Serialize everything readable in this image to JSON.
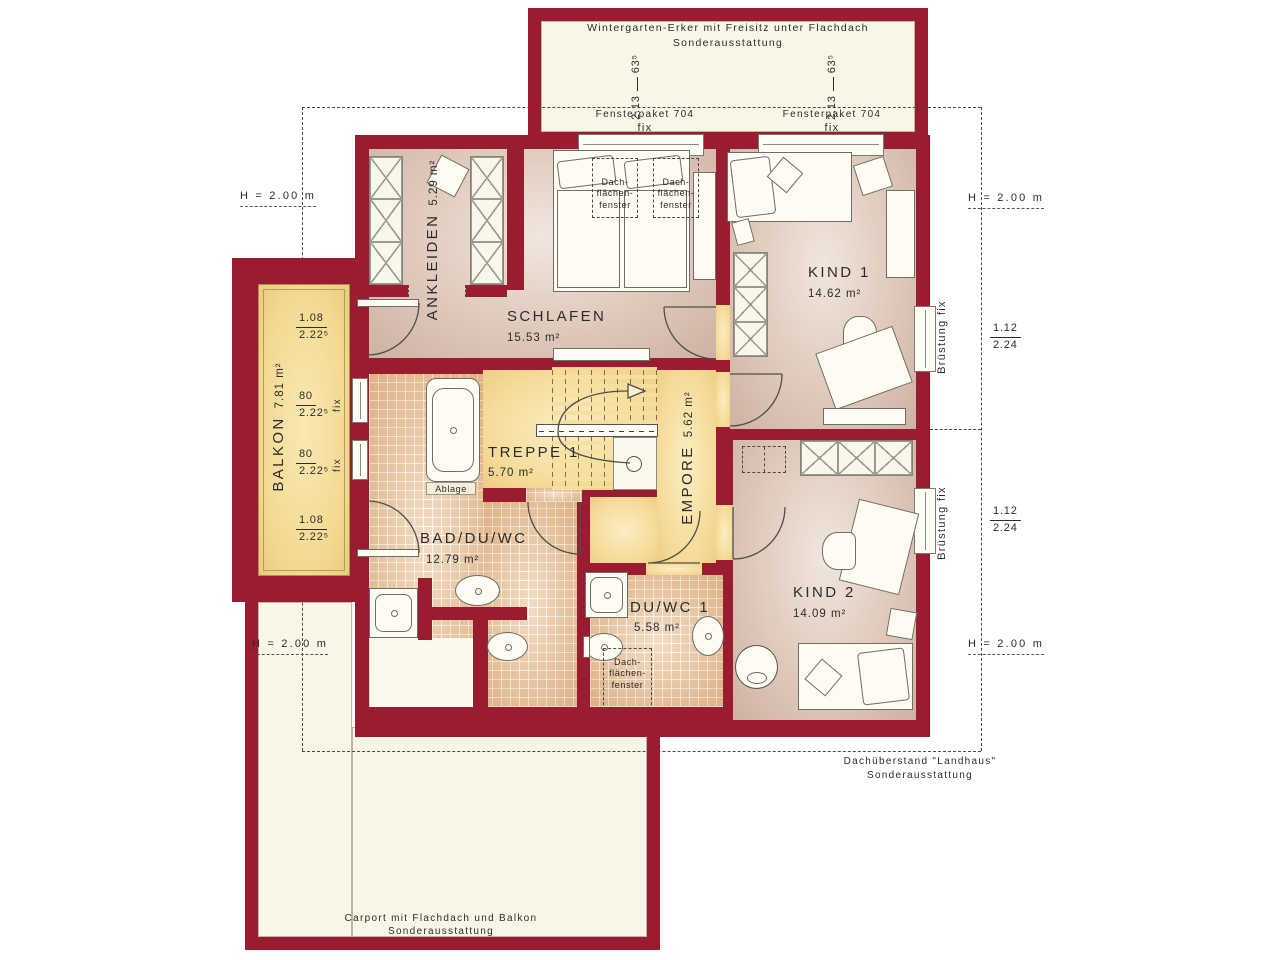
{
  "plan": {
    "title": {
      "line1": "Wintergarten-Erker mit Freisitz unter Flachdach",
      "line2": "Sonderausstattung"
    },
    "rooms": {
      "ankleiden": {
        "name": "ANKLEIDEN",
        "area": "5.29 m²"
      },
      "schlafen": {
        "name": "SCHLAFEN",
        "area": "15.53 m²"
      },
      "kind1": {
        "name": "KIND 1",
        "area": "14.62 m²"
      },
      "kind2": {
        "name": "KIND 2",
        "area": "14.09 m²"
      },
      "balkon": {
        "name": "BALKON",
        "area": "7.81 m²"
      },
      "treppe": {
        "name": "TREPPE 1",
        "area": "5.70 m²"
      },
      "empore": {
        "name": "EMPORE",
        "area": "5.62 m²"
      },
      "bad": {
        "name": "BAD/DU/WC",
        "area": "12.79 m²"
      },
      "duwc": {
        "name": "DU/WC 1",
        "area": "5.58 m²"
      }
    },
    "labels": {
      "height_clearance": "H = 2.00 m",
      "bruestung_fix": "Brüstung fix",
      "fix": "fix",
      "fensterpaket": "Fensterpaket 704",
      "ablage": "Ablage",
      "roof_window": {
        "l1": "Dach-",
        "l2": "flächen-",
        "l3": "fenster"
      },
      "carport": {
        "line1": "Carport mit Flachdach und Balkon",
        "line2": "Sonderausstattung"
      },
      "dachueberstand": {
        "line1": "Dachüberstand \"Landhaus\"",
        "line2": "Sonderausstattung"
      }
    },
    "dims": {
      "bay_window": {
        "num": "2.13",
        "den": "63⁵"
      },
      "balkon_door": {
        "num": "1.08",
        "den": "2.22⁵"
      },
      "balkon_fix": {
        "num": "80",
        "den": "2.22⁵"
      },
      "side_window": {
        "num": "1.12",
        "den": "2.24"
      }
    },
    "colors": {
      "wall": "#9A1C31",
      "floor_warm": "#DFC9BB",
      "floor_yellow": "#F6DC9B",
      "tile": "#EAC79F",
      "cream": "#FAF6E7"
    }
  }
}
